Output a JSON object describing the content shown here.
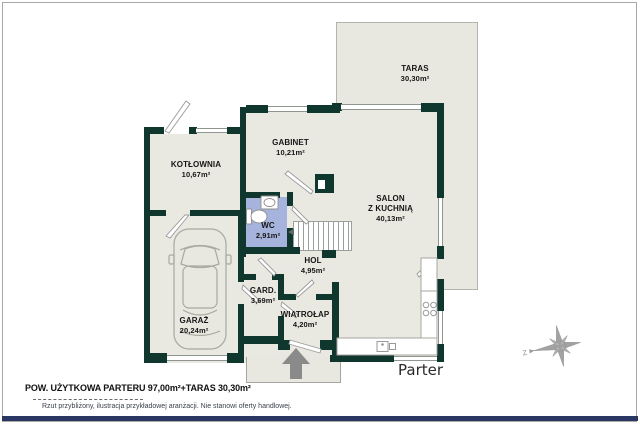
{
  "plan": {
    "floor_label": "Parter",
    "rooms": [
      {
        "id": "taras",
        "name": "TARAS",
        "area": "30,30m²"
      },
      {
        "id": "kotlownia",
        "name": "KOTŁOWNIA",
        "area": "10,67m²"
      },
      {
        "id": "gabinet",
        "name": "GABINET",
        "area": "10,21m²"
      },
      {
        "id": "salon",
        "name": "SALON",
        "name2": "Z KUCHNIĄ",
        "area": "40,13m²"
      },
      {
        "id": "wc",
        "name": "WC",
        "area": "2,91m²"
      },
      {
        "id": "hol",
        "name": "HOL",
        "area": "4,95m²"
      },
      {
        "id": "gard",
        "name": "GARD.",
        "area": "3,69m²"
      },
      {
        "id": "wiatrolap",
        "name": "WIATROŁAP",
        "area": "4,20m²"
      },
      {
        "id": "garaz",
        "name": "GARAŻ",
        "area": "20,24m²"
      }
    ],
    "compass": {
      "west_label": "Z"
    }
  },
  "footer": {
    "summary": "POW. UŻYTKOWA PARTERU 97,00m²+TARAS 30,30m²",
    "disclaimer": "Rzut przybliżony, ilustracja przykładowej aranżacji. Nie stanowi oferty handlowej."
  },
  "colors": {
    "wall": "#10372e",
    "floor": "#eae9e1",
    "wc_floor": "#a6b3dc",
    "accent_bar": "#2b3763",
    "compass": "#9b9b9b",
    "entrance_arrow": "#8a8a8a"
  }
}
